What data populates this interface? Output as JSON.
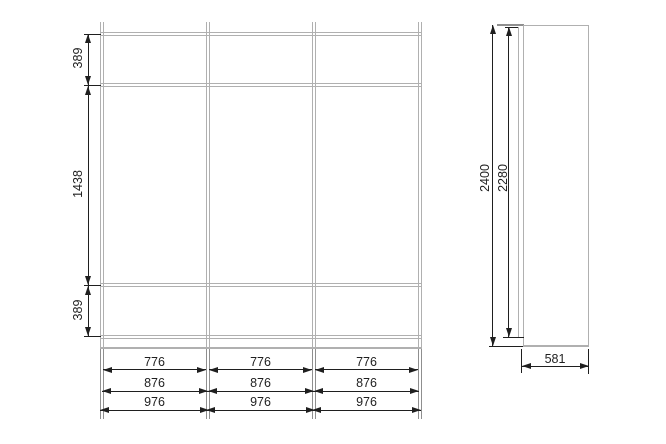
{
  "front_view": {
    "height_dims": [
      {
        "label": "389"
      },
      {
        "label": "1438"
      },
      {
        "label": "389"
      }
    ],
    "width_dim_rows": [
      {
        "values": [
          "776",
          "776",
          "776"
        ]
      },
      {
        "values": [
          "876",
          "876",
          "876"
        ]
      },
      {
        "values": [
          "976",
          "976",
          "976"
        ]
      }
    ]
  },
  "side_view": {
    "overall_height": "2400",
    "door_height": "2280",
    "depth": "581"
  },
  "colors": {
    "structure_line": "#b0b0b0",
    "structure_line_dark": "#8f8f8f",
    "dimension": "#1f1f1f",
    "background": "#ffffff"
  }
}
